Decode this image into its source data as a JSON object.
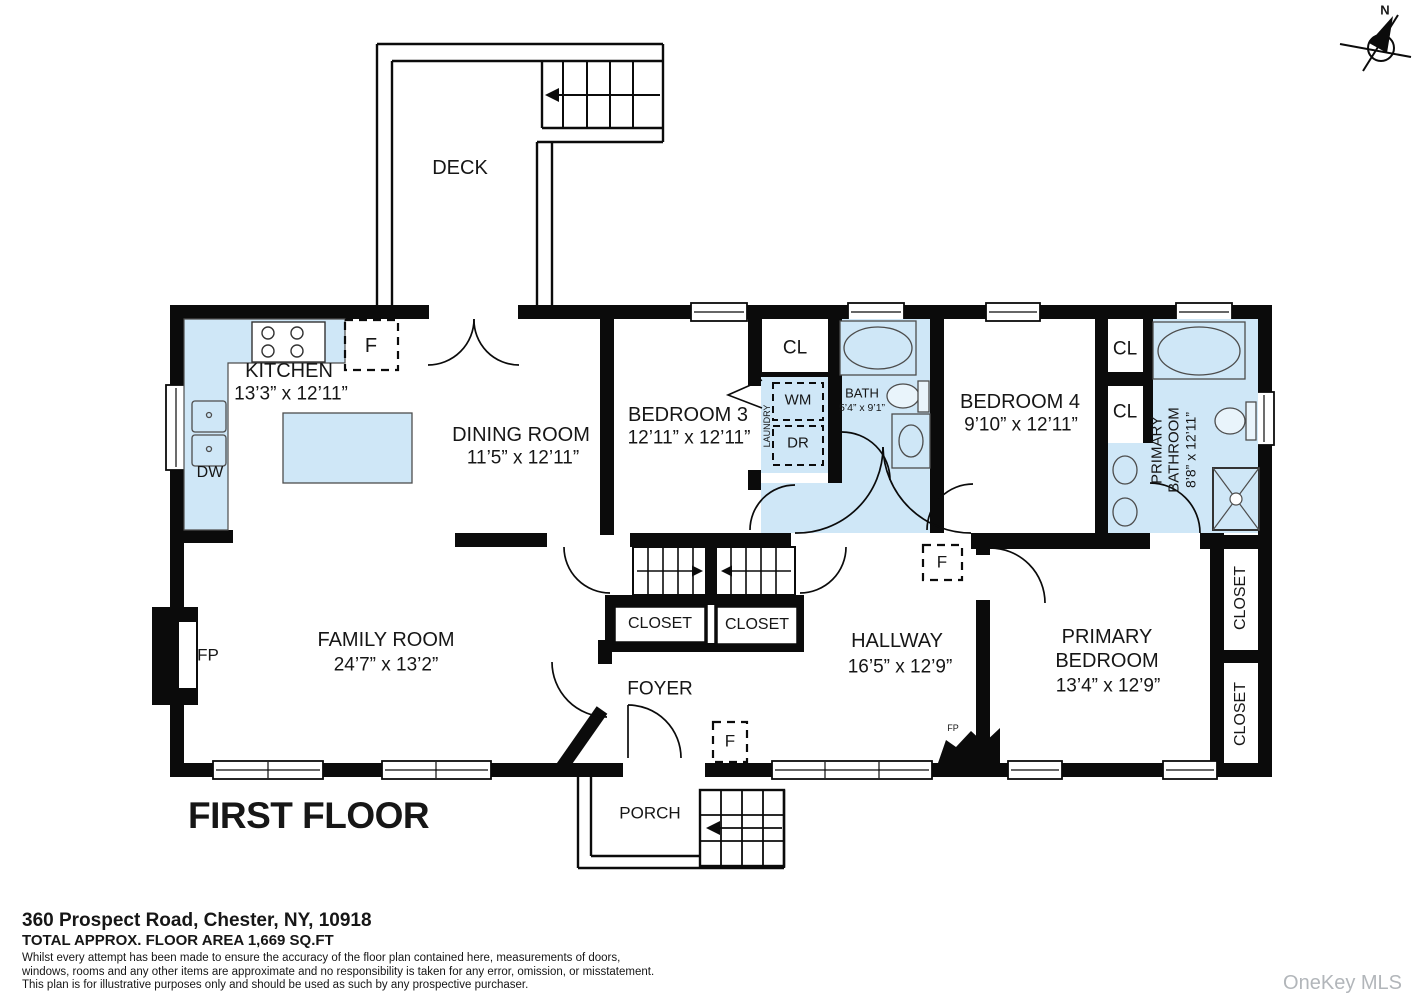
{
  "colors": {
    "wall": "#0b0b0b",
    "fixture_fill": "#cfe7f7",
    "watermark_gray": "#b2b6ba"
  },
  "title": "FIRST FLOOR",
  "compass": {
    "north_label": "N"
  },
  "watermark": "OneKey MLS",
  "rooms": {
    "deck": {
      "name": "DECK"
    },
    "kitchen": {
      "name": "KITCHEN",
      "dims": "13’3” x 12’11”"
    },
    "dining_room": {
      "name": "DINING ROOM",
      "dims": "11’5” x 12’11”"
    },
    "bedroom3": {
      "name": "BEDROOM 3",
      "dims": "12’11” x 12’11”"
    },
    "bath": {
      "name": "BATH",
      "dims": "5’4” x 9’1”"
    },
    "bedroom4": {
      "name": "BEDROOM 4",
      "dims": "9’10” x 12’11”"
    },
    "primary_bathroom": {
      "name_line1": "PRIMARY",
      "name_line2": "BATHROOM",
      "dims": "8’8” x 12’11”"
    },
    "hallway": {
      "name": "HALLWAY",
      "dims": "16’5” x 12’9”"
    },
    "primary_bedroom": {
      "name_line1": "PRIMARY",
      "name_line2": "BEDROOM",
      "dims": "13’4” x 12’9”"
    },
    "family_room": {
      "name": "FAMILY ROOM",
      "dims": "24’7” x 13’2”"
    },
    "foyer": {
      "name": "FOYER"
    },
    "porch": {
      "name": "PORCH"
    }
  },
  "labels": {
    "closet": "CLOSET",
    "cl": "CL",
    "fridge": "F",
    "dishwasher": "DW",
    "washing_machine": "WM",
    "dryer": "DR",
    "laundry": "LAUNDRY",
    "fireplace": "FP"
  },
  "footer": {
    "address": "360 Prospect Road, Chester, NY, 10918",
    "area": "TOTAL APPROX. FLOOR AREA 1,669 SQ.FT",
    "disclaimer_line1": "Whilst every attempt has been made to ensure the accuracy of the floor plan contained here, measurements of doors,",
    "disclaimer_line2": "windows, rooms and any other items are approximate and no responsibility is taken for any error, omission, or misstatement.",
    "disclaimer_line3": "This plan is for illustrative purposes only and should be used as such by any prospective purchaser."
  }
}
